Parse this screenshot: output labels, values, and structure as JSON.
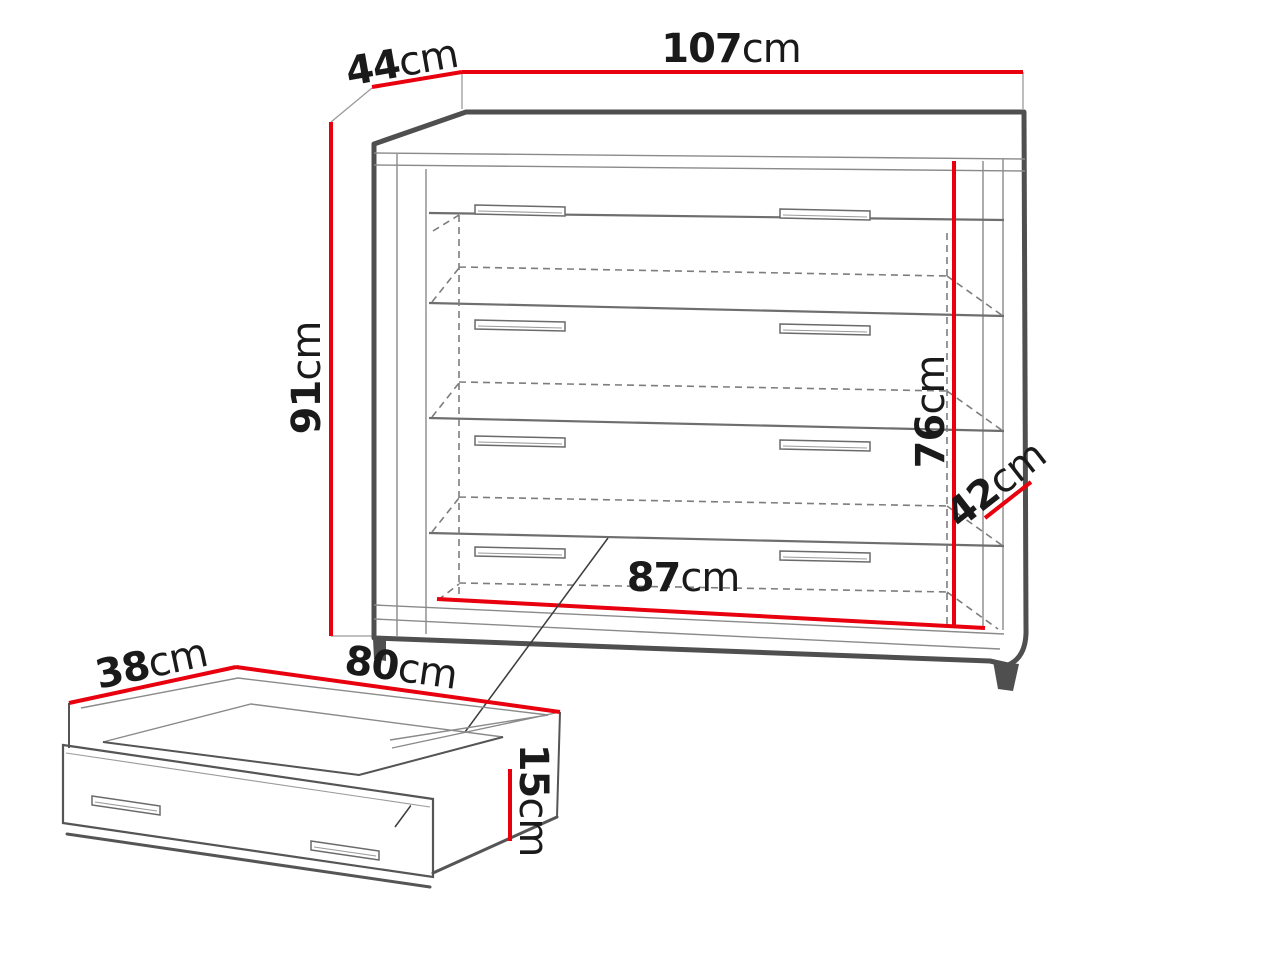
{
  "figure": {
    "type": "furniture-dimension-diagram",
    "subject": "chest of drawers with underbed drawer detail",
    "unit": "cm"
  },
  "colors": {
    "dimension_line": "#e8000f",
    "outline": "#4f4f4f",
    "background": "#ffffff"
  },
  "chest": {
    "drawer_count": 4,
    "width": {
      "value": "107",
      "unit": "cm"
    },
    "depth": {
      "value": "44",
      "unit": "cm"
    },
    "height": {
      "value": "91",
      "unit": "cm"
    },
    "interior_height": {
      "value": "76",
      "unit": "cm"
    },
    "side_depth": {
      "value": "42",
      "unit": "cm"
    },
    "interior_width": {
      "value": "87",
      "unit": "cm"
    }
  },
  "drawer": {
    "depth": {
      "value": "38",
      "unit": "cm"
    },
    "width": {
      "value": "80",
      "unit": "cm"
    },
    "height": {
      "value": "15",
      "unit": "cm"
    }
  }
}
